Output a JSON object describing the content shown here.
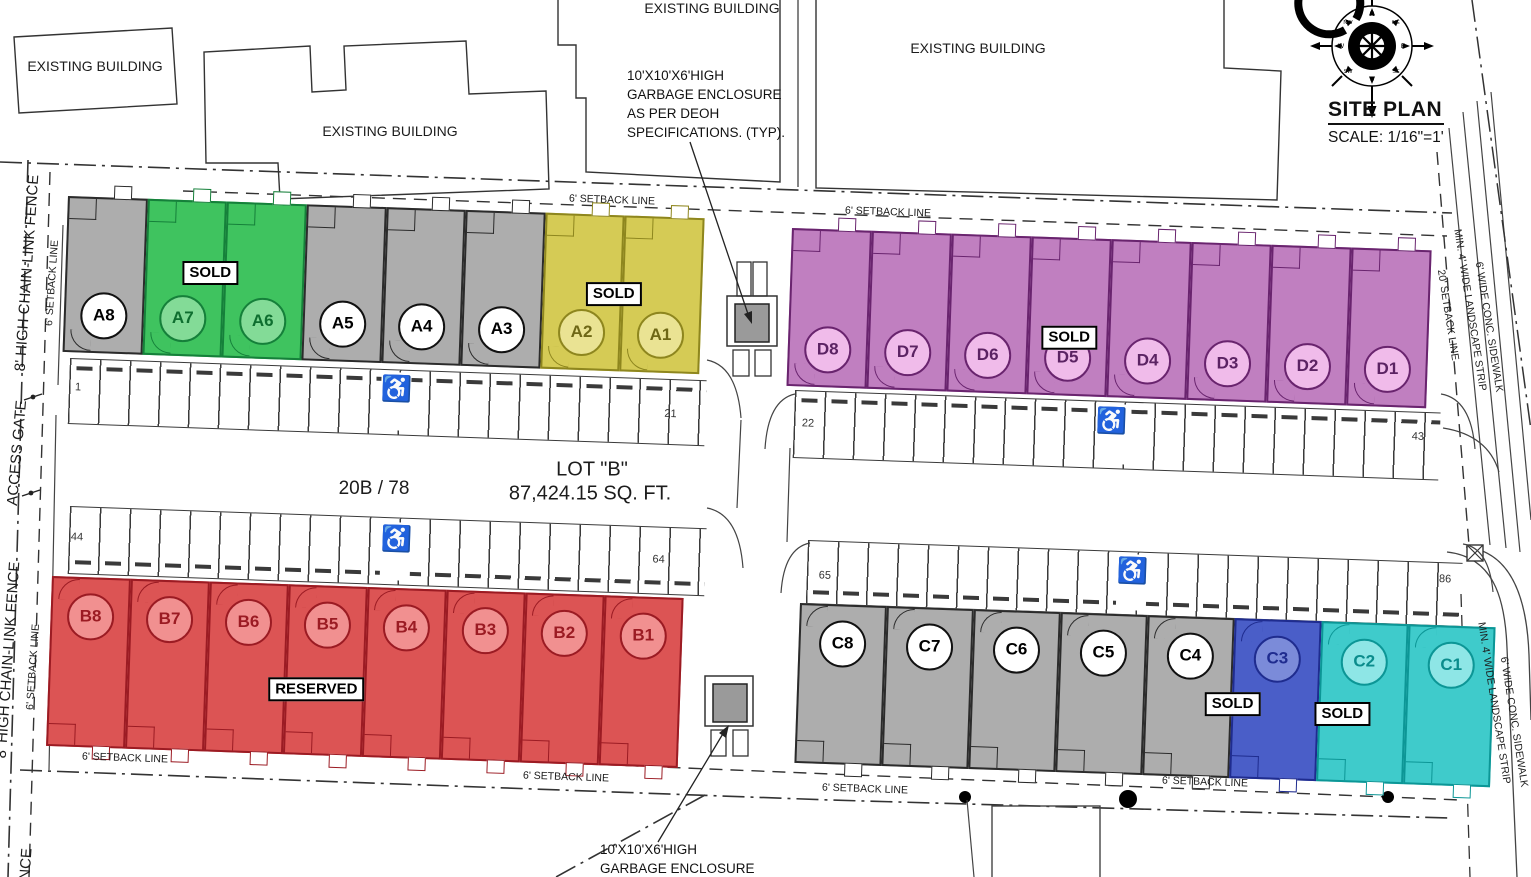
{
  "title_block": {
    "title": "SITE PLAN",
    "scale": "SCALE: 1/16\"=1'"
  },
  "compass": {
    "letters": [
      "N",
      "NE",
      "E",
      "SE",
      "S",
      "SW",
      "W",
      "NW"
    ]
  },
  "existing_building_label": "EXISTING BUILDING",
  "notes": {
    "garbage_top": [
      "10'X10'X6'HIGH",
      "GARBAGE ENCLOSURE",
      "AS PER DEOH",
      "SPECIFICATIONS. (TYP)."
    ],
    "garbage_bottom": [
      "10'X10'X6'HIGH",
      "GARBAGE ENCLOSURE"
    ]
  },
  "lot": {
    "name": "LOT \"B\"",
    "area": "87,424.15 SQ. FT.",
    "parcel": "20B / 78"
  },
  "site_labels": {
    "fence": "8' HIGH CHAIN-LINK FENCE",
    "fence_tail": "NCE",
    "access_gate": "ACCESS GATE",
    "setback_6": "6' SETBACK LINE",
    "setback_20": "20' SETBACK LINE",
    "landscape": "MIN. 4' WIDE LANDSCAPE STRIP",
    "sidewalk": "6' WIDE CONC. SIDEWALK"
  },
  "parking": {
    "handicap_icon": "♿",
    "row_a": [
      "1",
      "21"
    ],
    "row_d": [
      "22",
      "43"
    ],
    "row_b": [
      "44",
      "64"
    ],
    "row_c": [
      "65",
      "86"
    ]
  },
  "colors": {
    "gray": {
      "fill": "#ADADAD",
      "border": "#2B2B2B",
      "circle": "#FFFFFF",
      "text": "#000000"
    },
    "green": {
      "fill": "#3FC35F",
      "border": "#15803A",
      "circle": "#83DB97",
      "text": "#0E6E2F"
    },
    "yellow": {
      "fill": "#D5CB55",
      "border": "#8E861E",
      "circle": "#EAE393",
      "text": "#6E6716"
    },
    "purple": {
      "fill": "#C07FC0",
      "border": "#69246E",
      "circle": "#F0BBEA",
      "text": "#5B2363"
    },
    "red": {
      "fill": "#DC5454",
      "border": "#9B1B23",
      "circle": "#F19090",
      "text": "#9B1B23"
    },
    "blue": {
      "fill": "#4A5EC8",
      "border": "#1F2C8F",
      "circle": "#7B8BD9",
      "text": "#1F2C8F"
    },
    "cyan": {
      "fill": "#3FCBCB",
      "border": "#0C9696",
      "circle": "#8EE6E6",
      "text": "#0B8C8C"
    }
  },
  "buildings": {
    "a": {
      "line1": "WAREHOUSE",
      "line2": "BUILDING \"A\"",
      "footprint": "FOOTPRINT: 10,000 SQ. FT.",
      "title_color": "#111111",
      "status_labels": [
        "SOLD",
        "SOLD"
      ],
      "units": [
        {
          "label": "A8",
          "color": "gray"
        },
        {
          "label": "A7",
          "color": "green"
        },
        {
          "label": "A6",
          "color": "green"
        },
        {
          "label": "A5",
          "color": "gray"
        },
        {
          "label": "A4",
          "color": "gray"
        },
        {
          "label": "A3",
          "color": "gray"
        },
        {
          "label": "A2",
          "color": "yellow"
        },
        {
          "label": "A1",
          "color": "yellow"
        }
      ]
    },
    "d": {
      "line1": "WAREHOUSE",
      "line2": "BUILDING \"D\"",
      "footprint": "FOOTPRINT: 10,000 SQ. FT.",
      "title_color": "#5B2363",
      "status_labels": [
        "SOLD"
      ],
      "units": [
        {
          "label": "D8",
          "color": "purple"
        },
        {
          "label": "D7",
          "color": "purple"
        },
        {
          "label": "D6",
          "color": "purple"
        },
        {
          "label": "D5",
          "color": "purple"
        },
        {
          "label": "D4",
          "color": "purple"
        },
        {
          "label": "D3",
          "color": "purple"
        },
        {
          "label": "D2",
          "color": "purple"
        },
        {
          "label": "D1",
          "color": "purple"
        }
      ]
    },
    "b": {
      "line1": "WAREHOUSE",
      "line2": "BUILDING \"B\"",
      "footprint": "FOOTPRINT: 10,000 SQ. FT.",
      "title_color": "#9B1B23",
      "status_labels": [
        "RESERVED"
      ],
      "units": [
        {
          "label": "B8",
          "color": "red"
        },
        {
          "label": "B7",
          "color": "red"
        },
        {
          "label": "B6",
          "color": "red"
        },
        {
          "label": "B5",
          "color": "red"
        },
        {
          "label": "B4",
          "color": "red"
        },
        {
          "label": "B3",
          "color": "red"
        },
        {
          "label": "B2",
          "color": "red"
        },
        {
          "label": "B1",
          "color": "red"
        }
      ]
    },
    "c": {
      "line1": "WAREHOUSE",
      "line2": "BUILDING \"C\"",
      "footprint": "FOOTPRINT: 10,000 SQ. FT.",
      "title_color": "#111111",
      "status_labels": [
        "SOLD",
        "SOLD"
      ],
      "units": [
        {
          "label": "C8",
          "color": "gray"
        },
        {
          "label": "C7",
          "color": "gray"
        },
        {
          "label": "C6",
          "color": "gray"
        },
        {
          "label": "C5",
          "color": "gray"
        },
        {
          "label": "C4",
          "color": "gray"
        },
        {
          "label": "C3",
          "color": "blue"
        },
        {
          "label": "C2",
          "color": "cyan"
        },
        {
          "label": "C1",
          "color": "cyan"
        }
      ]
    }
  }
}
